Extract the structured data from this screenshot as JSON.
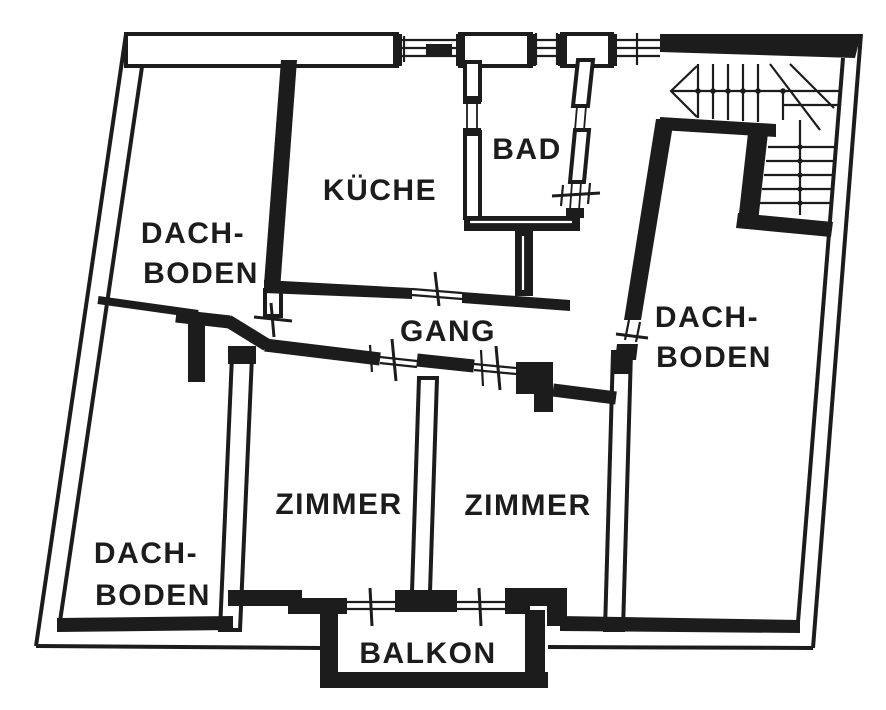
{
  "colors": {
    "ink": "#1c1c1c",
    "background": "#ffffff"
  },
  "labels": {
    "dachboden_top_left_line1": "DACH-",
    "dachboden_top_left_line2": "BODEN",
    "kueche": "KÜCHE",
    "bad": "BAD",
    "gang": "GANG",
    "dachboden_right_line1": "DACH-",
    "dachboden_right_line2": "BODEN",
    "zimmer_left": "ZIMMER",
    "zimmer_right": "ZIMMER",
    "dachboden_bottom_left_line1": "DACH-",
    "dachboden_bottom_left_line2": "BODEN",
    "balkon": "BALKON"
  }
}
